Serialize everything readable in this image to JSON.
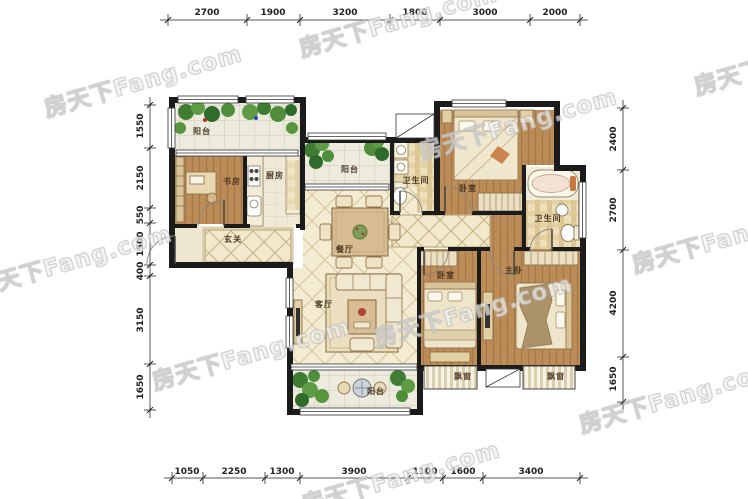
{
  "watermark": {
    "text": "房天下Fang.com"
  },
  "colors": {
    "wall": "#1b1b1b",
    "wood_floor": "#bd8d58",
    "tile_floor": "#f4ecd2",
    "plaid_floor": "#eddfb9",
    "balcony_floor": "#edeade",
    "plant_green": "#4f8f3c",
    "accent_orange": "#c8793f"
  },
  "dimensions": {
    "top": [
      "2700",
      "1900",
      "3200",
      "1800",
      "3000",
      "2000"
    ],
    "bottom": [
      "1050",
      "2250",
      "1300",
      "3900",
      "1100",
      "1600",
      "3400"
    ],
    "left": [
      "1550",
      "2150",
      "550",
      "1500",
      "400",
      "3150",
      "1650"
    ],
    "right": [
      "2400",
      "2700",
      "4200",
      "1650"
    ]
  },
  "rooms": [
    {
      "id": "balcony-northwest",
      "label": "阳台"
    },
    {
      "id": "study",
      "label": "书房"
    },
    {
      "id": "kitchen",
      "label": "厨房"
    },
    {
      "id": "balcony-north",
      "label": "阳台"
    },
    {
      "id": "bathroom",
      "label": "卫生间"
    },
    {
      "id": "entry-hall",
      "label": "玄关"
    },
    {
      "id": "dining-room",
      "label": "餐厅"
    },
    {
      "id": "living-room",
      "label": "客厅"
    },
    {
      "id": "bedroom-north",
      "label": "卧室"
    },
    {
      "id": "master-bathroom",
      "label": "卫生间"
    },
    {
      "id": "bedroom-middle",
      "label": "卧室"
    },
    {
      "id": "master-bedroom",
      "label": "主卧"
    },
    {
      "id": "bay-window-middle",
      "label": "飘窗"
    },
    {
      "id": "bay-window-master",
      "label": "飘窗"
    },
    {
      "id": "balcony-south",
      "label": "阳台"
    }
  ]
}
